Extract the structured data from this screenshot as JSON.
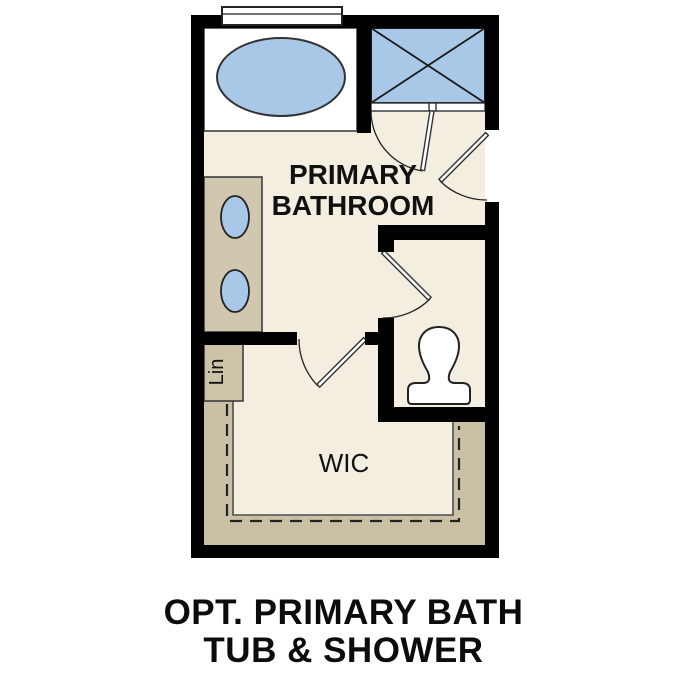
{
  "diagram_type": "floor-plan",
  "caption": {
    "line1": "OPT. PRIMARY BATH",
    "line2": "TUB & SHOWER"
  },
  "labels": {
    "room_line1": "PRIMARY",
    "room_line2": "BATHROOM",
    "walk_in_closet": "WIC",
    "linen": "Lin"
  },
  "fixtures": [
    "window",
    "bathtub",
    "walk-in-shower",
    "shower-door",
    "entry-door",
    "double-sink-vanity",
    "linen-closet",
    "water-closet-door",
    "toilet",
    "walk-in-closet-door",
    "closet-shelving",
    "closet-rods"
  ],
  "colors": {
    "wall": "#000000",
    "floor": "#f4eee1",
    "fixture_blue": "#a9c8e8",
    "fixture_white": "#ffffff",
    "vanity_tan": "#d1c7ae",
    "linen_tan": "#cdc3a9",
    "shelf_tan": "#c9c0a6",
    "text": "#111111"
  }
}
